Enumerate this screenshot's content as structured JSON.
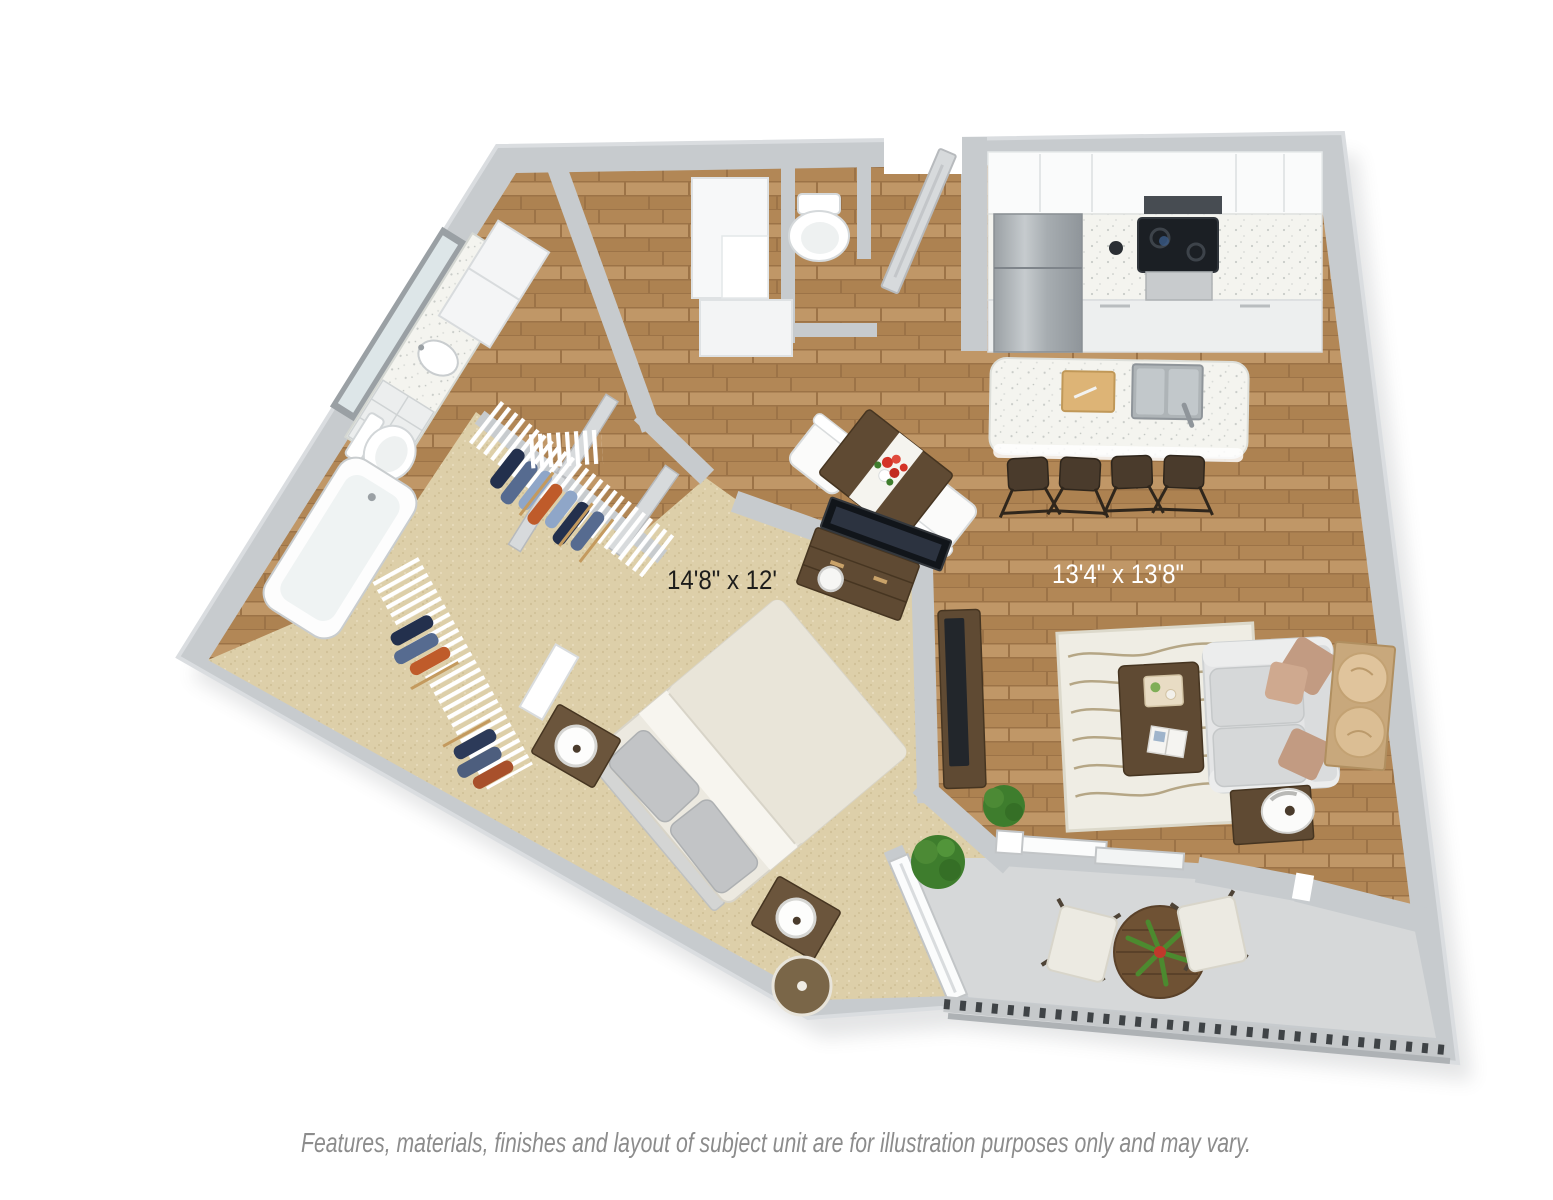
{
  "page": {
    "background_color": "#ffffff",
    "description": "3D top-down apartment floor plan rendering"
  },
  "floor_plan": {
    "type": "3d-apartment-floor-plan",
    "rooms": {
      "bedroom": {
        "label": "14'8\" x 12'",
        "floor": "carpet"
      },
      "living_kitchen": {
        "label": "13'4\" x 13'8\"",
        "floor": "hardwood"
      },
      "bathroom": {
        "floor": "hardwood"
      },
      "walk_in_closet": {
        "floor": "carpet"
      },
      "balcony": {
        "floor": "concrete"
      }
    },
    "furniture": [
      "double-sink vanity with mirror",
      "toilet",
      "bathtub",
      "linen cabinet",
      "walk-in closet wire shelving with hanging clothes",
      "entry built-in shelves",
      "powder room toilet",
      "queen bed with gray pillows",
      "two nightstands with round lamps",
      "bedroom dresser with flat-screen tv",
      "round ottoman",
      "dining table with red flowers and two chairs",
      "refrigerator",
      "cooktop with microwave and oven",
      "kitchen island with double sink and cutting board",
      "four bar stools",
      "tv stand with flat-screen tv",
      "area rug with wave pattern",
      "coffee table with tray and magazine",
      "loveseat sofa with accent pillows",
      "side table with lamp",
      "round wall art panels",
      "potted plants",
      "balcony bistro table with plant",
      "two balcony chairs",
      "balcony railing"
    ],
    "colors": {
      "wall": "#c7cbce",
      "wall_edge": "#dadde0",
      "wood": "#b9905f",
      "wood_dark": "#9c7347",
      "carpet": "#ddcfa9",
      "balcony_floor": "#d6d8d9",
      "counter_white": "#f4f4ef",
      "dark_wood": "#5f4a33",
      "sofa": "#e4e5e6",
      "rug": "#efede4",
      "stool": "#4a3b2c",
      "plant_green": "#3e7d2d",
      "flower_red": "#d43327",
      "tv_black": "#22262b",
      "label_dark": "#1d1d1b",
      "label_light": "#ffffff",
      "disclaimer_gray": "#8c8c8c"
    }
  },
  "labels": {
    "bedroom_dimensions": "14'8\" x 12'",
    "living_dimensions": "13'4\" x 13'8\""
  },
  "disclaimer": {
    "text": "Features, materials, finishes and layout of subject unit are for illustration purposes only and may vary."
  }
}
